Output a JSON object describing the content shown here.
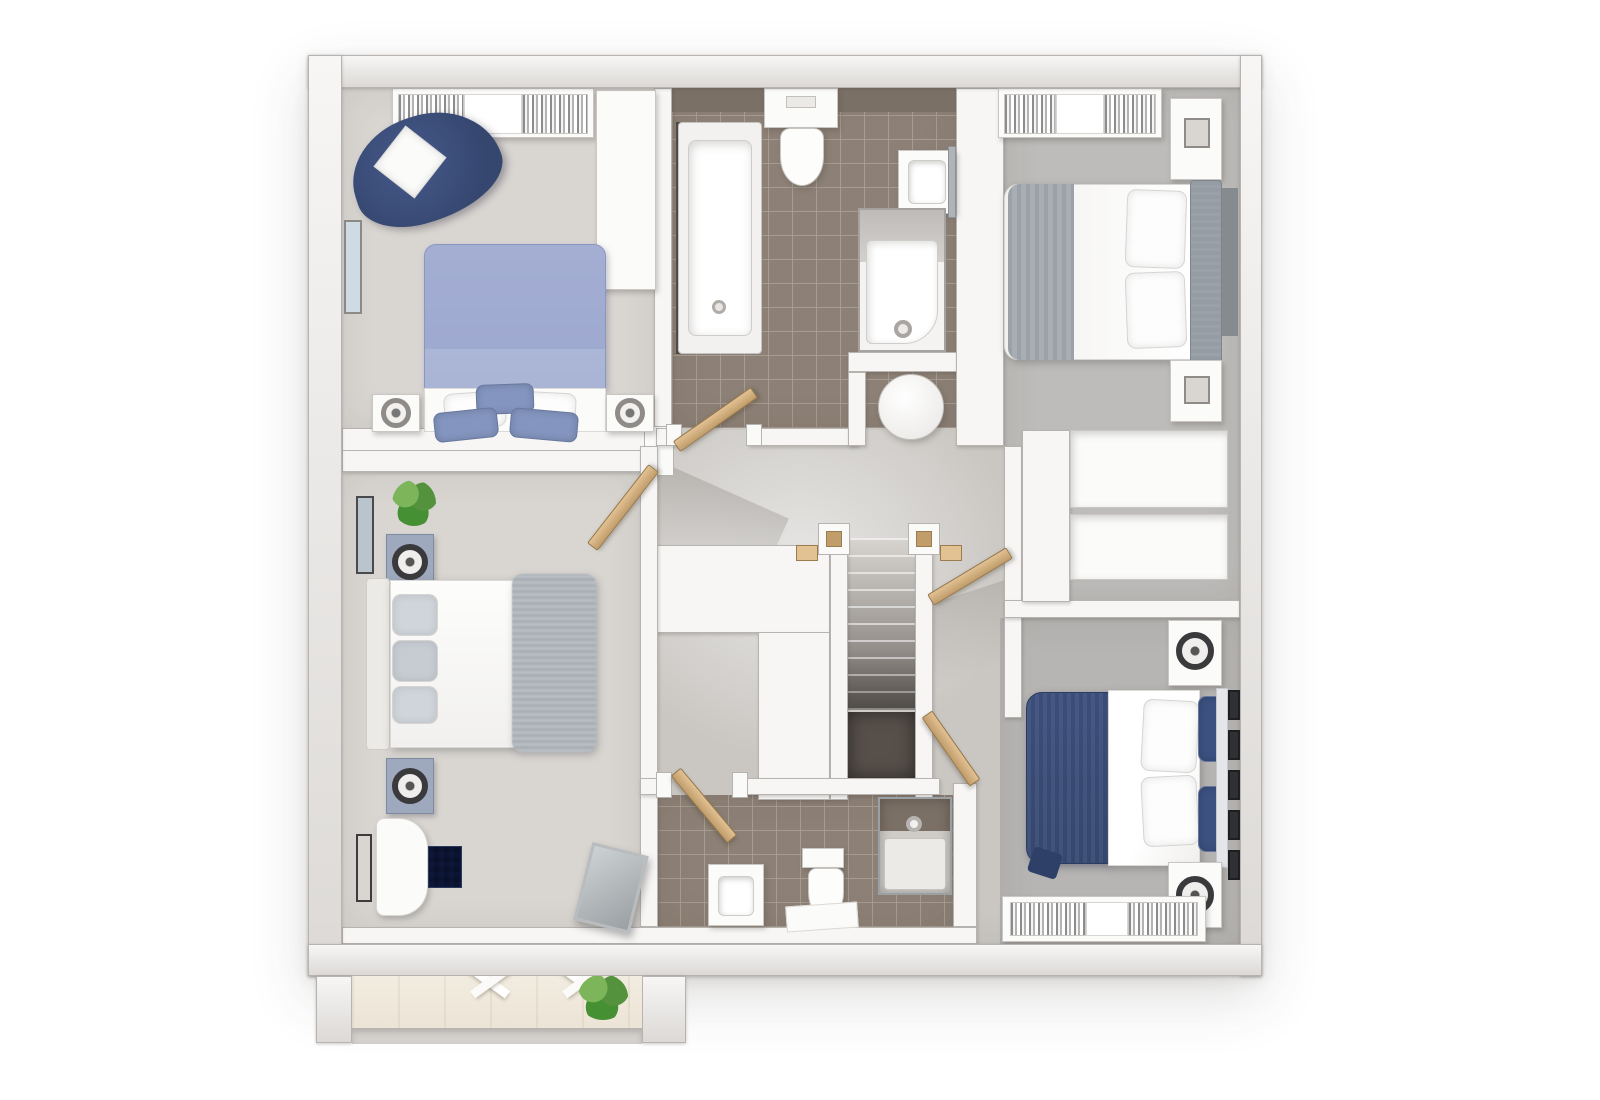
{
  "scene": {
    "kind": "3d-floorplan-render",
    "view": "top-down-dollhouse",
    "floor": "upper-storey",
    "background": "#ffffff",
    "visible_text": "none"
  },
  "palette": {
    "wall": "#dcd9d6",
    "wallHi": "#f7f6f5",
    "wallLine": "#b6b3b0",
    "landing": "#cac7c3",
    "carpetLight": "#d9d6d2",
    "carpetMid": "#bebcba",
    "carpetDark": "#b7b5b3",
    "tile": "#8d8076",
    "tileDark": "#7b7066",
    "grout": "#a79c91",
    "wood": "#ece4d6",
    "woodLip": "#d3d0cd",
    "navy": "#35476f",
    "blue": "#8496c0",
    "periwinkle": "#9da8cf",
    "grayThrow": "#a8aeb4",
    "headboardGray": "#959ca4",
    "doorWood": "#c19d6b",
    "doorEdge": "#e2c193",
    "plantGreen": "#4a8a36",
    "voidDark": "#57504a",
    "mirror": "#aeb4b7"
  },
  "rooms": [
    {
      "id": "bedroom-1",
      "position": "top-left",
      "floor": "light-carpet",
      "furniture": [
        "double-bed-periwinkle-duvet",
        "blue-white-pillows",
        "armchair-navy-with-cushion",
        "fitted-wardrobe-open",
        "tall-white-cabinet",
        "nightstand-with-lamp-left",
        "nightstand-with-lamp-right",
        "wall-art"
      ]
    },
    {
      "id": "family-bathroom",
      "position": "top-middle",
      "floor": "taupe-tile",
      "furniture": [
        "bathtub-with-screen",
        "toilet",
        "wash-basin-with-mirror",
        "shower-bath-enclosure"
      ]
    },
    {
      "id": "bedroom-2",
      "position": "top-right",
      "floor": "gray-carpet",
      "furniture": [
        "double-bed-white-duvet-gray-throw",
        "upholstered-headboard",
        "white-pillows",
        "fitted-wardrobe-open",
        "nightstand-top",
        "nightstand-bottom"
      ]
    },
    {
      "id": "master-bedroom",
      "position": "bottom-left",
      "floor": "light-carpet",
      "furniture": [
        "double-bed-white-duvet-fluffy-throw",
        "cream-headboard",
        "gray-pillows",
        "nightstand-with-lamp-top",
        "nightstand-with-lamp-bottom",
        "chaise-white",
        "ottoman-navy",
        "leaning-mirror",
        "potted-plant",
        "wall-art-x2"
      ]
    },
    {
      "id": "en-suite",
      "position": "bottom-middle",
      "floor": "taupe-tile",
      "furniture": [
        "shower-enclosure-dark-tile",
        "toilet",
        "wash-basin",
        "bath-mat"
      ]
    },
    {
      "id": "bedroom-3",
      "position": "bottom-right",
      "floor": "gray-carpet",
      "furniture": [
        "double-bed-navy-duvet",
        "navy-accent-pillows",
        "white-pillows",
        "nightstand-with-lamp-top",
        "nightstand-with-lamp-bottom",
        "gallery-wall-five-frames",
        "fitted-wardrobe-open"
      ]
    },
    {
      "id": "landing",
      "position": "center",
      "floor": "gray-carpet",
      "furniture": [
        "staircase-descending",
        "stair-newel-posts",
        "round-side-table-in-alcove",
        "boxed-bulkhead-l-shape",
        "built-in-cupboard-upper",
        "built-in-cupboard-lower",
        "under-stair-void"
      ]
    },
    {
      "id": "gallery-bay",
      "position": "bottom-left-projection",
      "floor": "timber",
      "furniture": [
        "white-roof-beams",
        "potted-plant"
      ]
    }
  ],
  "staircase": {
    "treads": 10,
    "newel_posts": 2,
    "direction": "down"
  },
  "doors": [
    {
      "room": "master-bedroom",
      "state": "ajar"
    },
    {
      "room": "family-bathroom",
      "state": "ajar"
    },
    {
      "room": "bedroom-2",
      "state": "ajar"
    },
    {
      "room": "bedroom-3",
      "state": "ajar"
    },
    {
      "room": "en-suite",
      "state": "ajar"
    }
  ]
}
